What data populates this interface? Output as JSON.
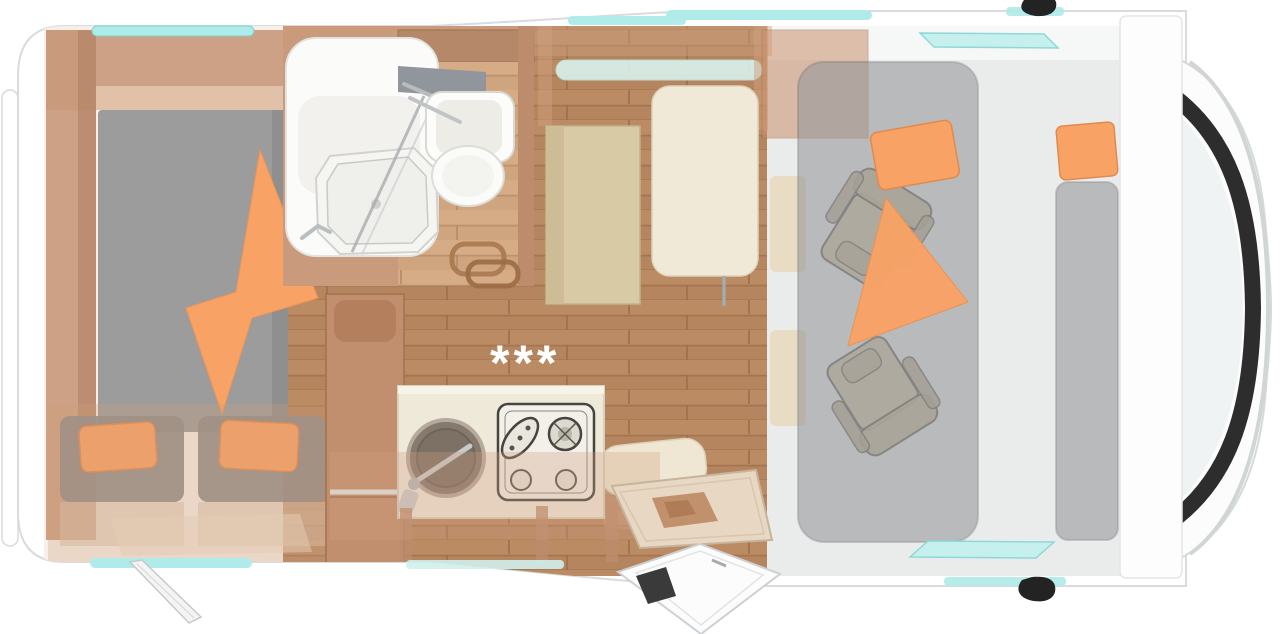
{
  "floorplan": {
    "stars_label": "***",
    "rooms": {
      "rear_bedroom": {
        "items": [
          "island-bed",
          "blanket",
          "bench-seat-left",
          "bench-seat-right",
          "wardrobe"
        ]
      },
      "bathroom": {
        "items": [
          "corner-shower",
          "shower-tray",
          "mirror",
          "washbasin",
          "toilet",
          "towel-rails"
        ]
      },
      "kitchen": {
        "items": [
          "counter",
          "round-sink",
          "faucet",
          "gas-stove"
        ]
      },
      "dinette": {
        "items": [
          "bench",
          "table",
          "side-seat",
          "side-window"
        ]
      },
      "entry": {
        "items": [
          "entry-step",
          "open-door",
          "awning-strut"
        ]
      },
      "cab": {
        "items": [
          "drop-down-bed",
          "pillow",
          "pillow",
          "pillow",
          "captain-chair-left",
          "captain-chair-right",
          "windshield",
          "side-mirror-top",
          "side-mirror-bottom"
        ]
      }
    }
  },
  "colors": {
    "teal": "#aeebe9",
    "teal_light": "#d8f1ec",
    "teal_stroke": "#84d6d4",
    "orange": "#f8a266",
    "orange_stroke": "#e08a4e",
    "wood_floor": "#b5855f",
    "wood_floor_light": "#cfa57f",
    "wood_wall": "#c99a7c",
    "wood_cabinet": "#c28f6e",
    "overlay_tan": "#cf9f7f",
    "mattress_gray": "#9c9c9c",
    "bench_gray": "#8e8c89",
    "seat_beige": "#cfc0a0",
    "table_cream": "#f0e9d7",
    "counter_cream": "#efe9da",
    "cab_floor": "#eaecec",
    "dropbed_gray": "#97999c",
    "windshield_black": "#2d2d2d",
    "mirror_black": "#232323",
    "body_white": "#ffffff",
    "body_stroke": "#d9dcde",
    "glass_gray": "#f0f3f3"
  }
}
